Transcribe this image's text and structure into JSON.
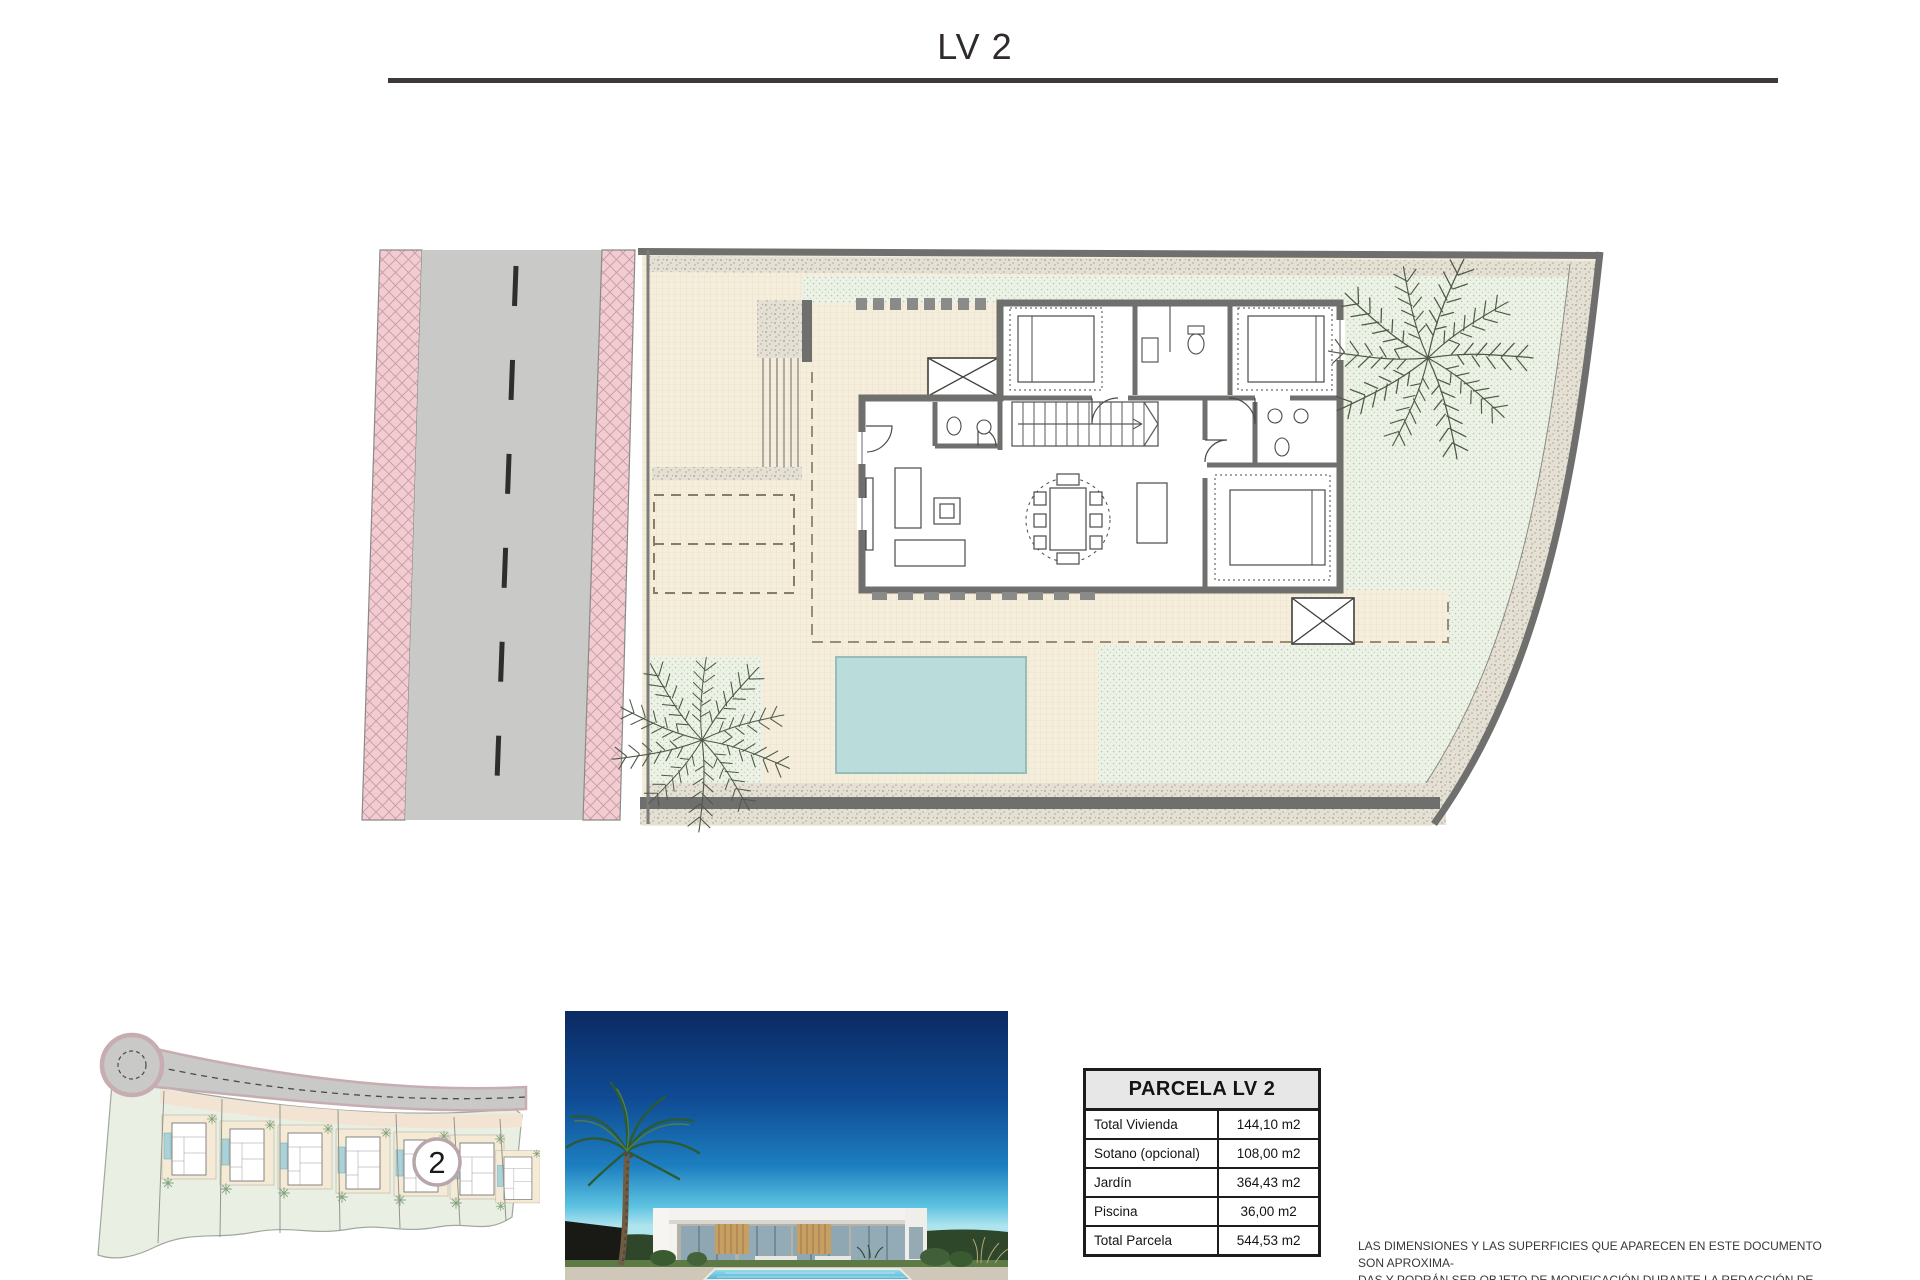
{
  "title": "LV 2",
  "table": {
    "header": "PARCELA LV 2",
    "rows": [
      {
        "label": "Total Vivienda",
        "value": "144,10 m2"
      },
      {
        "label": "Sotano (opcional)",
        "value": "108,00 m2"
      },
      {
        "label": "Jardín",
        "value": "364,43 m2"
      },
      {
        "label": "Piscina",
        "value": "36,00 m2"
      },
      {
        "label": "Total Parcela",
        "value": "544,53 m2"
      }
    ]
  },
  "site_overview": {
    "plot_marker": "2"
  },
  "disclaimer": {
    "line1": "LAS DIMENSIONES Y LAS SUPERFICIES QUE APARECEN EN ESTE DOCUMENTO SON APROXIMA-",
    "line2": "DAS Y PODRÁN SER OBJETO DE MODIFICACIÓN DURANTE LA REDACCIÓN DE LOS PROYECTOS",
    "line3": "BÁSICO Y DE EJECUCIÓN."
  },
  "colors": {
    "rule": "#3e3837",
    "road_gray": "#c9c9c7",
    "sidewalk_pink": "#f2ccd1",
    "wall_gray": "#6f6f6e",
    "terrace_beige": "#f5eedd",
    "garden_green": "#edf2e7",
    "pool_blue": "#badcdb",
    "table_header_bg": "#e7e7e7"
  },
  "icons": {
    "palm-tree-icon": "line-art palm starburst",
    "plot-marker-circle": "white numbered circle"
  }
}
